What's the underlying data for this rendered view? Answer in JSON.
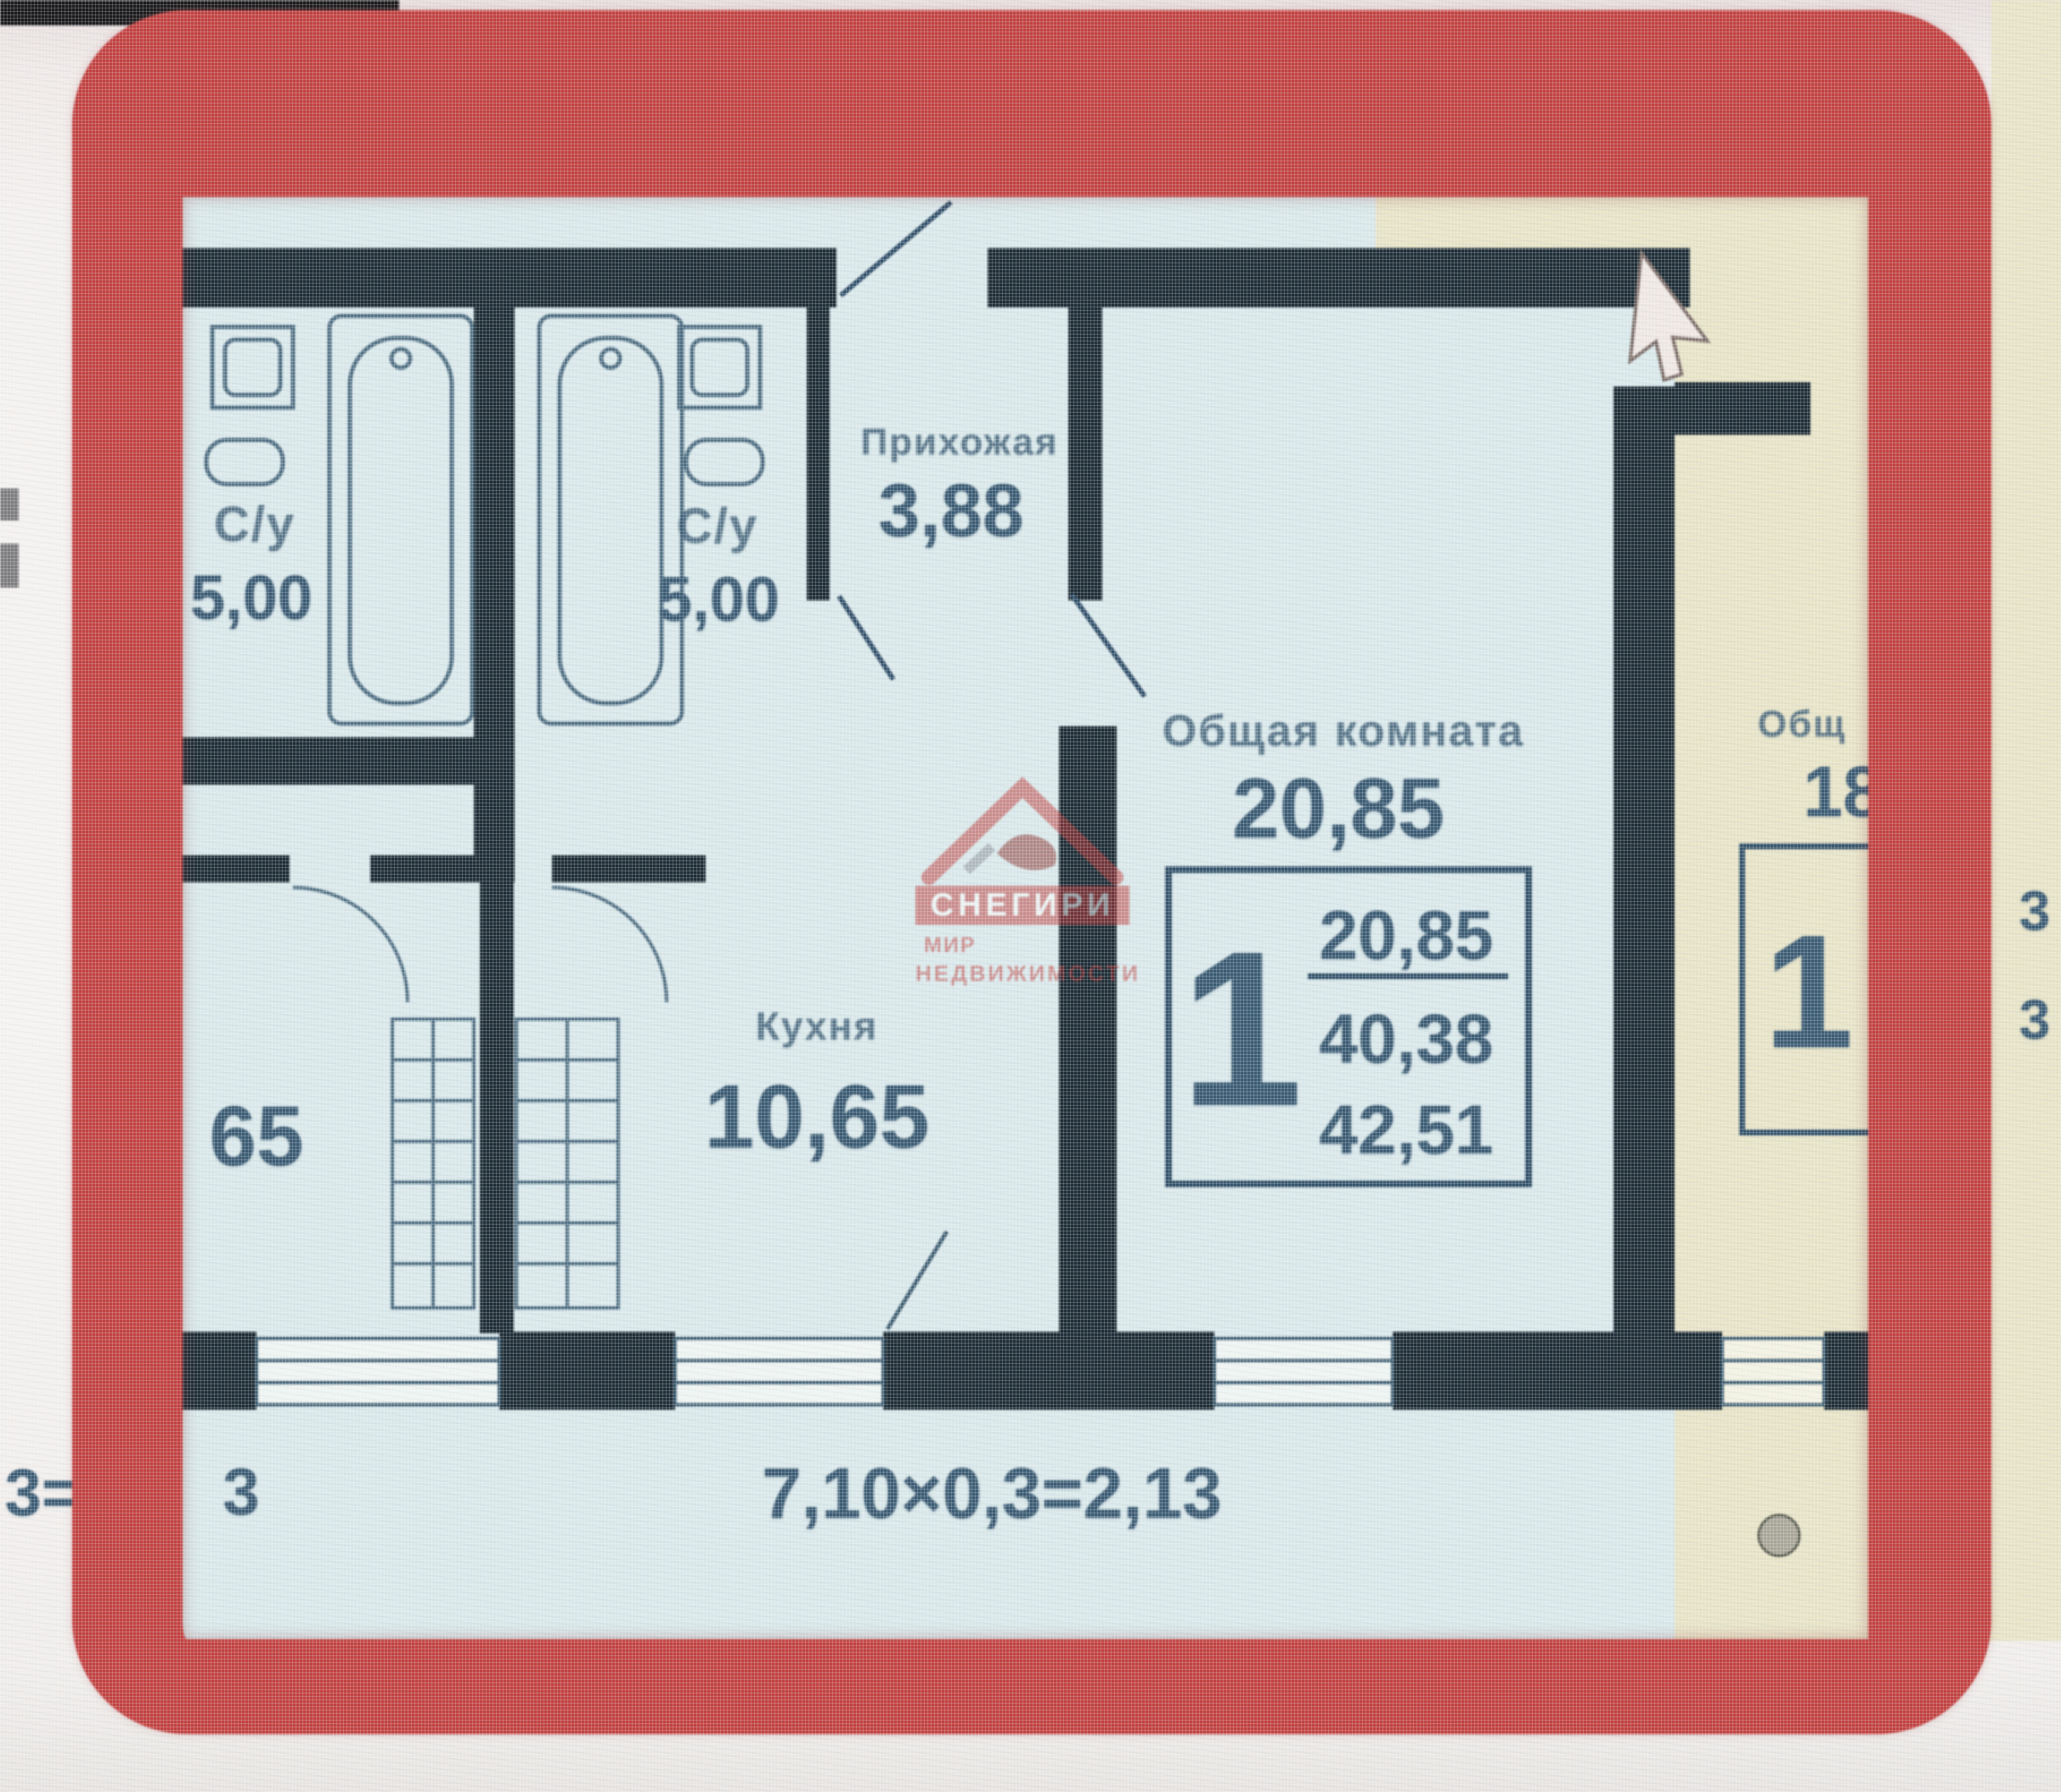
{
  "colors": {
    "highlight_frame": "#c4403f",
    "plan_background": "#d9e8ea",
    "neighbor_background": "#e7e3c6",
    "wall": "#1e2d36",
    "line": "#46687e",
    "text": "#3a5b74",
    "watermark_red": "#bf3a38"
  },
  "plan": {
    "left_neighbor": {
      "bathroom_label": "С/у",
      "bathroom_area": "5,00",
      "kitchen_area_partial": "65",
      "dimension_fragment_outer": "3=",
      "dimension_fragment_inner": "3"
    },
    "apartment": {
      "bathroom_label": "С/у",
      "bathroom_area": "5,00",
      "hallway_label": "Прихожая",
      "hallway_area": "3,88",
      "kitchen_label": "Кухня",
      "kitchen_area": "10,65",
      "living_label": "Общая комната",
      "living_area": "20,85",
      "info_box": {
        "rooms": "1",
        "living_area": "20,85",
        "area_no_balcony": "40,38",
        "total_area": "42,51"
      },
      "dimension_line": "7,10×0,3=2,13"
    },
    "right_neighbor": {
      "living_label_partial": "Общ",
      "living_area_partial": "18",
      "info_box_rooms": "1",
      "fragment_top": "3",
      "fragment_bottom": "3"
    }
  },
  "watermark": {
    "brand": "СНЕГИРИ",
    "tagline_1": "МИР",
    "tagline_2": "НЕДВИЖИМОСТИ"
  }
}
